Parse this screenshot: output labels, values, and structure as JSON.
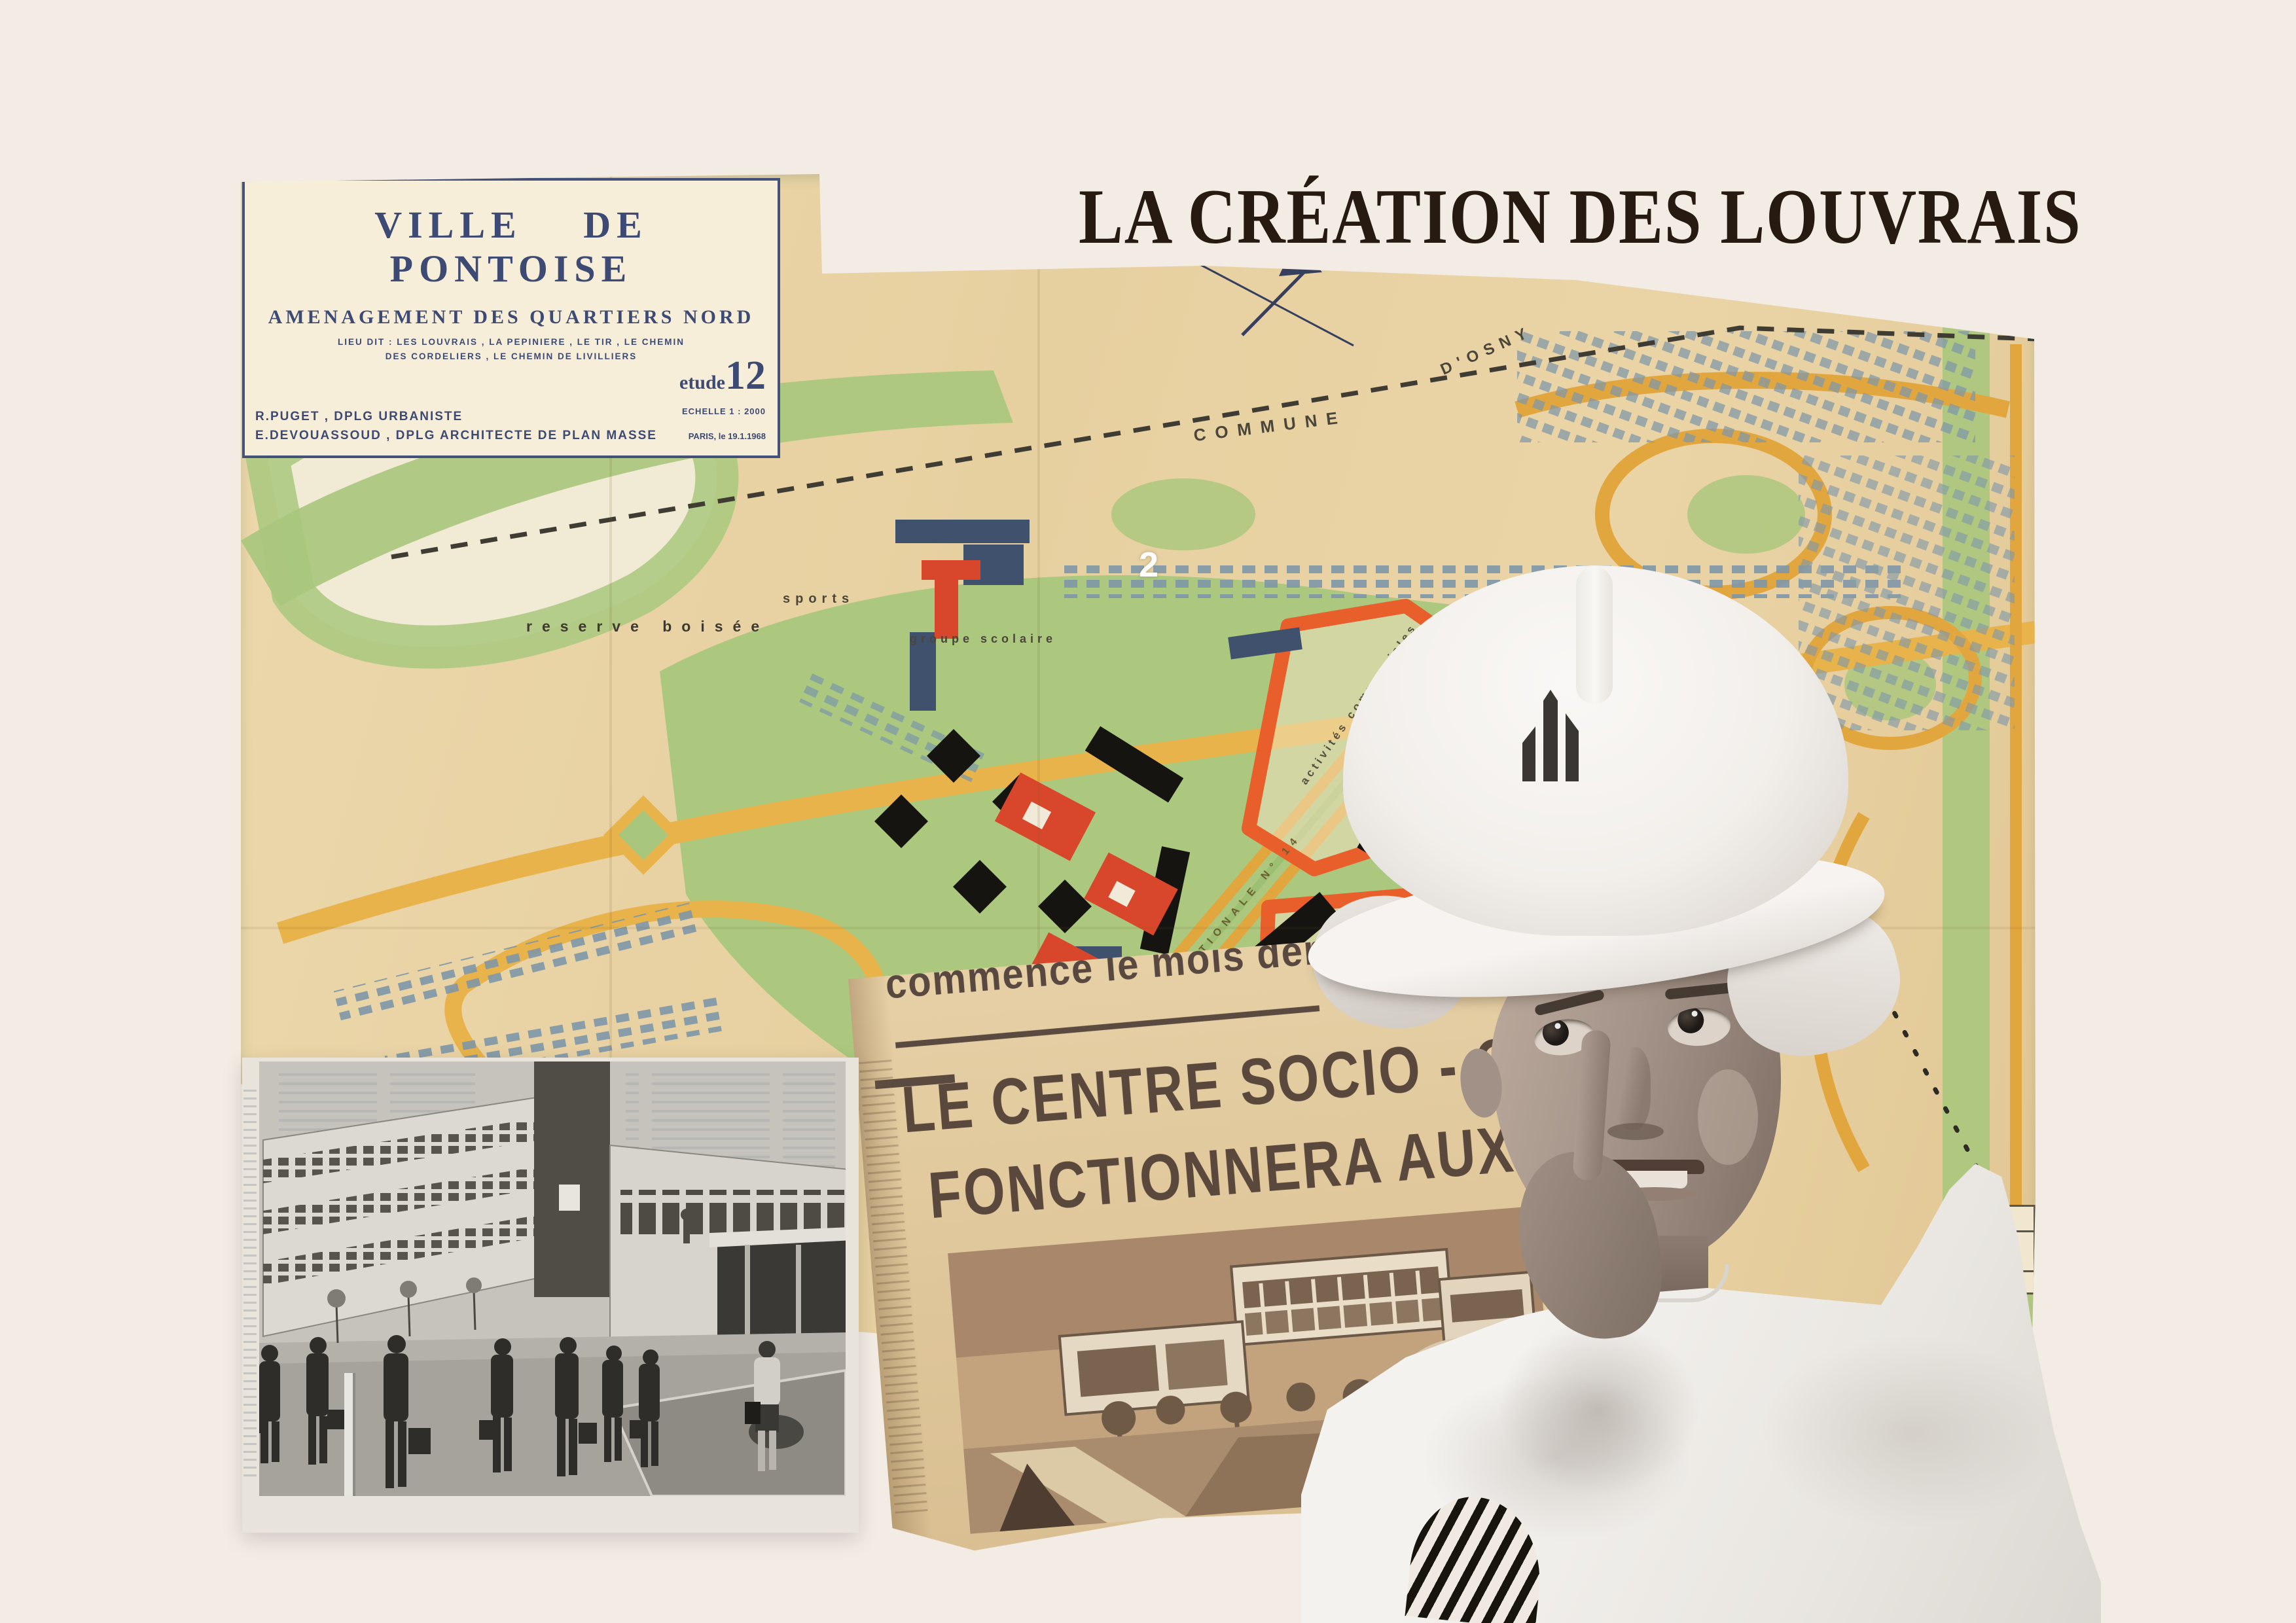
{
  "poster": {
    "title": "LA CRÉATION DES LOUVRAIS",
    "background_color": "#f3ece5",
    "title_color": "#261a11"
  },
  "map": {
    "paper_color": "#e8d2a4",
    "ink_color": "#3d4a74",
    "cartouche": {
      "city": "VILLE DE PONTOISE",
      "subtitle": "AMENAGEMENT DES QUARTIERS NORD",
      "lieu_dit_1": "LIEU DIT : LES LOUVRAIS , LA PEPINIERE , LE TIR , LE CHEMIN",
      "lieu_dit_2": "DES CORDELIERS , LE CHEMIN DE LIVILLIERS",
      "etude_label": "etude",
      "etude_number": "12",
      "echelle": "ECHELLE 1 : 2000",
      "place_date": "PARIS, le 19.1.1968",
      "credit_urbaniste": "R.PUGET , DPLG URBANISTE",
      "credit_architecte": "E.DEVOUASSOUD , DPLG ARCHITECTE DE PLAN MASSE"
    },
    "labels": {
      "commune": "COMMUNE",
      "osny": "D'OSNY",
      "reserve_boisee": "reserve boisée",
      "sports": "sports",
      "groupe_scolaire": "groupe scolaire",
      "sector_number": "2",
      "activites_1": "activités commerciales",
      "activites_2": "activités commerciales",
      "route_nationale": "ROUTE NATIONALE N° 14"
    },
    "totals_table": {
      "header": "total",
      "row1": "580",
      "row2": "370",
      "footer": "450"
    },
    "colors": {
      "green_zones": "#a8c77c",
      "yellow_roads": "#e7b34a",
      "orange_zone_outline": "#e85f2c",
      "black_buildings": "#161410",
      "blue_houses": "#7e97a9",
      "red_buildings": "#d8472b"
    }
  },
  "newspaper": {
    "kicker": "commence le mois dernier",
    "headline_line1": "LE CENTRE SOCIO - CULTUREL DE",
    "headline_line2": "FONCTIONNERA AUX LOUVRAIS EN OCTO",
    "paper_color": "#e3cba0",
    "ink_color": "#5a483d"
  },
  "school_photo": {
    "photo_style_color": "#c7c4bd"
  },
  "boy": {
    "helmet_color": "#f2efeb",
    "shirt_color": "#f4f2ef"
  }
}
